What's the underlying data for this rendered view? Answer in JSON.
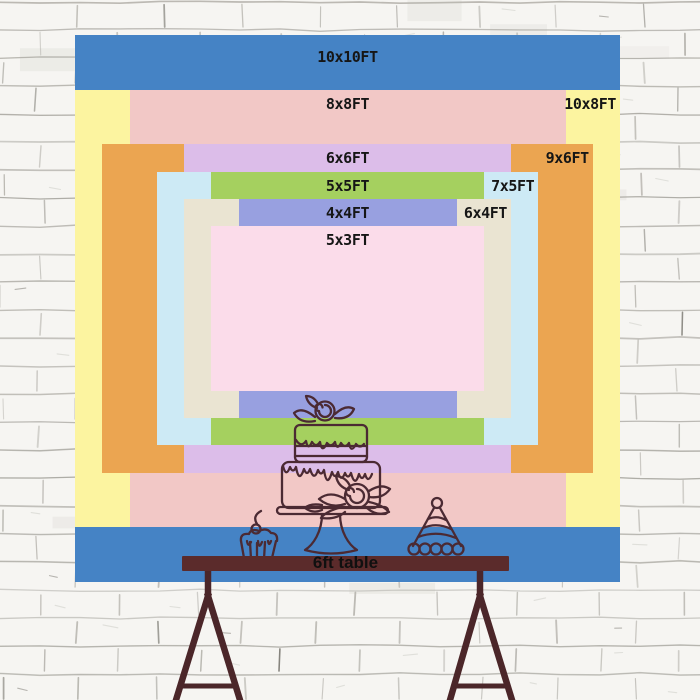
{
  "diagram": {
    "unit": "FT",
    "sizes": [
      {
        "label": "10x10FT",
        "w_ft": 10,
        "h_ft": 10,
        "color": "#4583c5",
        "label_align": "center"
      },
      {
        "label": "10x8FT",
        "w_ft": 10,
        "h_ft": 8,
        "color": "#fcf4a0",
        "label_align": "right"
      },
      {
        "label": "8x8FT",
        "w_ft": 8,
        "h_ft": 8,
        "color": "#f2c8c6",
        "label_align": "center"
      },
      {
        "label": "9x6FT",
        "w_ft": 9,
        "h_ft": 6,
        "color": "#eba551",
        "label_align": "right"
      },
      {
        "label": "6x6FT",
        "w_ft": 6,
        "h_ft": 6,
        "color": "#dcbde9",
        "label_align": "center"
      },
      {
        "label": "7x5FT",
        "w_ft": 7,
        "h_ft": 5,
        "color": "#cdeaf5",
        "label_align": "right"
      },
      {
        "label": "5x5FT",
        "w_ft": 5,
        "h_ft": 5,
        "color": "#a5d05f",
        "label_align": "center"
      },
      {
        "label": "6x4FT",
        "w_ft": 6,
        "h_ft": 4,
        "color": "#eae4d2",
        "label_align": "right"
      },
      {
        "label": "4x4FT",
        "w_ft": 4,
        "h_ft": 4,
        "color": "#98a0e0",
        "label_align": "center"
      },
      {
        "label": "5x3FT",
        "w_ft": 5,
        "h_ft": 3,
        "color": "#fbdcea",
        "label_align": "center"
      }
    ]
  },
  "table": {
    "label": "6ft table"
  },
  "decor": {
    "icons": [
      "cupcake",
      "two-tier-birthday-cake",
      "party-hat"
    ]
  },
  "colors": {
    "label_text": "#161616",
    "table_wood": "#5b2b2b",
    "easel_wood": "#4b2629",
    "line_art": "#4b2a33",
    "wall_background": "#f6f5f2",
    "mortar_line": "#b5b3ad"
  }
}
